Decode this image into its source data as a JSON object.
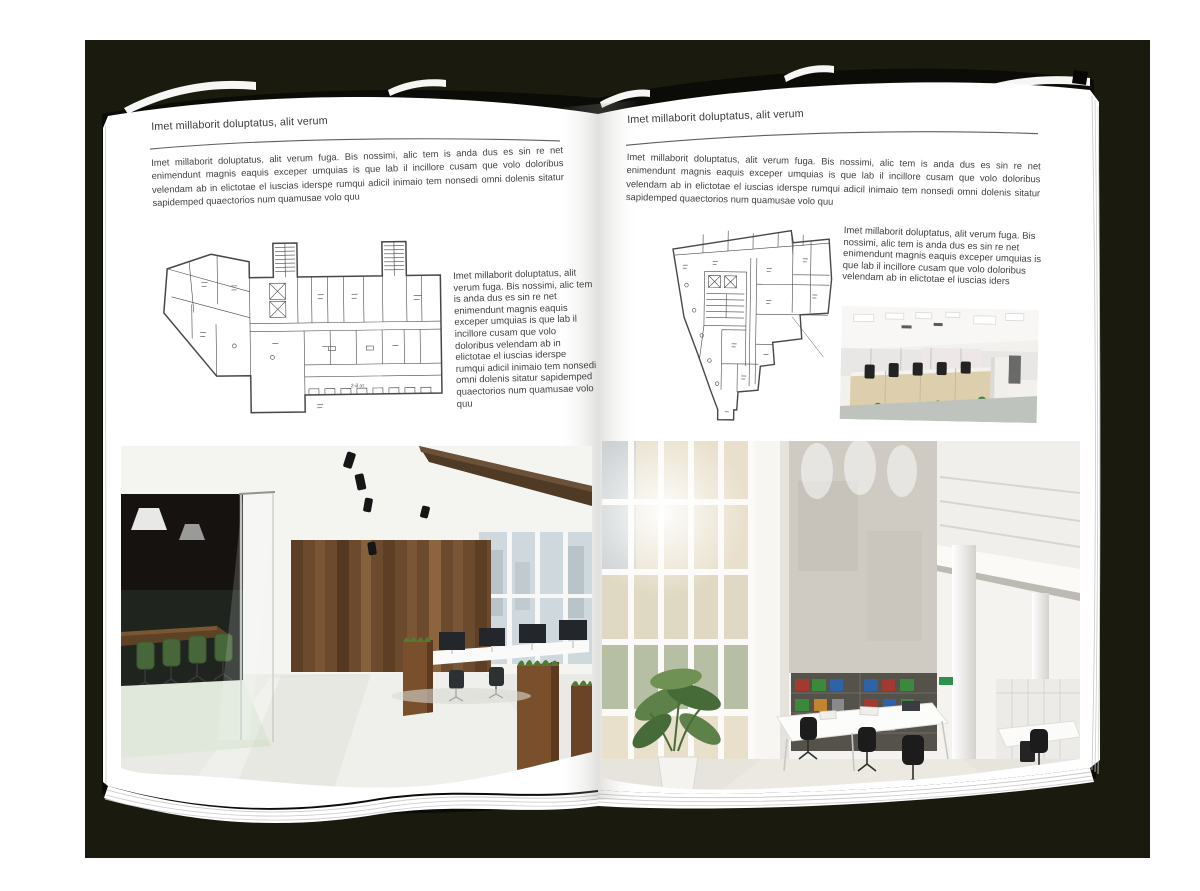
{
  "document_type": "open-brochure-spread-mockup",
  "colors": {
    "backdrop": "#1b1a0e",
    "cover": "#0b0b07",
    "page": "#ffffff",
    "body_text": "#414141",
    "rule": "#5f5f5f",
    "plan_line": "#474747",
    "wood_accent": "#6b4a2e",
    "chair_green": "#47663a",
    "concrete": "#cfcbc3"
  },
  "left_page": {
    "header": "Imet millaborit doluptatus, alit verum",
    "intro": "Imet millaborit doluptatus, alit verum fuga. Bis nossimi, alic tem is anda dus es sin re net enimendunt magnis eaquis exceper umquias is que lab il incillore cusam que volo doloribus velendam ab in elictotae el iuscias iderspe rumqui adicil inimaio tem nonsedi omni dolenis sitatur sapidemped quaectorios num quamusae volo quu",
    "column_text": "Imet millaborit doluptatus, alit verum fuga. Bis nossimi, alic tem is anda dus es sin re net enimendunt magnis eaquis exceper umquias is que lab il incillore cusam que volo doloribus velendam ab in elictotae el iuscias iderspe rumqui adicil inimaio tem nonsedi omni dolenis sitatur sapidemped quaectorios num quamusae volo quu",
    "plan_note": "2-й эт",
    "floor_plan_alt": "Elongated building floor plan with angled left wing and two stair towers",
    "photo_alt": "Loft office interior with dark wood wall, glass meeting room and green chairs"
  },
  "right_page": {
    "header": "Imet millaborit doluptatus, alit verum",
    "intro": "Imet millaborit doluptatus, alit verum fuga. Bis nossimi, alic tem is anda dus es sin re net enimendunt magnis eaquis exceper umquias is que lab il incillore cusam que volo doloribus velendam ab in elictotae el iuscias iderspe rumqui adicil inimaio tem nonsedi omni dolenis sitatur sapidemped quaectorios num quamusae volo quu",
    "column_text": "Imet millaborit doluptatus, alit verum fuga. Bis nossimi, alic tem is anda dus es sin re net enimendunt magnis eaquis exceper umquias is que lab il incillore cusam que volo doloribus velendam ab in elictotae el iuscias iders",
    "floor_plan_alt": "Irregular triangular building floor plan with central core and bottom stem",
    "photo_small_alt": "Bright open-plan office with light wood workstations and black chairs",
    "photo_alt": "White double-height office atrium with glass facade, binder shelves and white desks"
  }
}
